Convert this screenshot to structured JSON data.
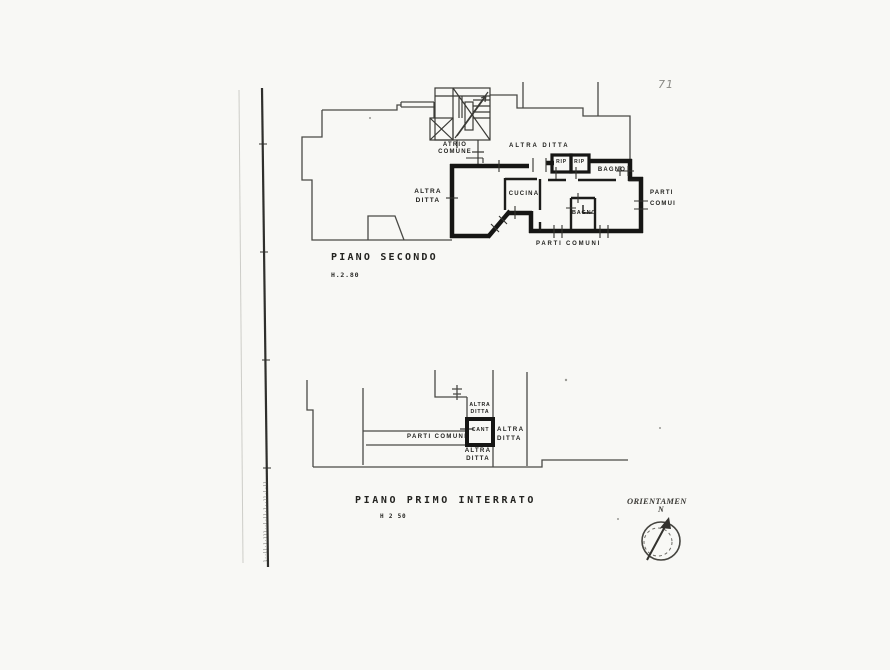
{
  "page": {
    "number": "71",
    "margin_microtext": "l··ll·l·lll··l·ll·l··ll·l·ll"
  },
  "colors": {
    "paper": "#f8f8f5",
    "ink": "#161614",
    "thin_line": "#4a4a46",
    "faint_line": "#c9c9c4"
  },
  "upper_plan": {
    "title": "PIANO SECONDO",
    "height_label": "H.2.80",
    "labels": {
      "atrio_line1": "ATRIO",
      "atrio_line2": "COMUNE",
      "altra_ditta_top": "ALTRA DITTA",
      "rip_left": "RIP",
      "rip_right": "RIP",
      "bagno_top": "BAGNO",
      "altra_ditta_left_line1": "ALTRA",
      "altra_ditta_left_line2": "DITTA",
      "cucina": "CUCINA",
      "bagno_mid": "BAGNO",
      "parti_right_line1": "PARTI",
      "parti_right_line2": "COMUI",
      "parti_bottom": "PARTI COMUNI"
    }
  },
  "lower_plan": {
    "title": "PIANO PRIMO INTERRATO",
    "height_label": "H 2 50",
    "labels": {
      "altra_top_line1": "ALTRA",
      "altra_top_line2": "DITTA",
      "cant": "CANT",
      "parti_comuni": "PARTI COMUNI",
      "altra_right_line1": "ALTRA",
      "altra_right_line2": "DITTA",
      "altra_bottom_line1": "ALTRA",
      "altra_bottom_line2": "DITTA"
    }
  },
  "compass": {
    "label": "ORIENTAMEN",
    "north": "N"
  }
}
